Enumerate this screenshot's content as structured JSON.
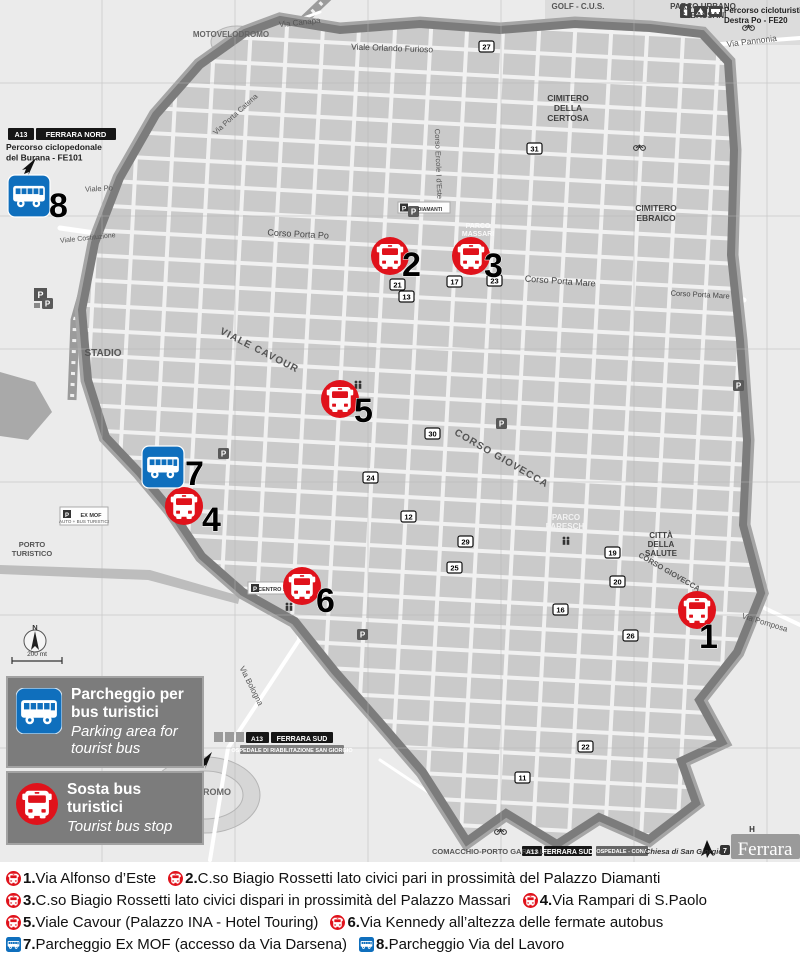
{
  "colors": {
    "stop_red": "#e0121b",
    "parking_blue": "#0f6fbd",
    "wall_gray": "#7c7c7c",
    "cemetery_gray": "#a6a6a6"
  },
  "map": {
    "markers": [
      {
        "num": "1",
        "type": "stop",
        "x": 697,
        "y": 610,
        "ndx": 2,
        "ndy": 38
      },
      {
        "num": "2",
        "type": "stop",
        "x": 390,
        "y": 256,
        "ndx": 12,
        "ndy": 20
      },
      {
        "num": "3",
        "type": "stop",
        "x": 471,
        "y": 256,
        "ndx": 13,
        "ndy": 21
      },
      {
        "num": "4",
        "type": "stop",
        "x": 184,
        "y": 506,
        "ndx": 18,
        "ndy": 25
      },
      {
        "num": "5",
        "type": "stop",
        "x": 340,
        "y": 399,
        "ndx": 14,
        "ndy": 23
      },
      {
        "num": "6",
        "type": "stop",
        "x": 302,
        "y": 586,
        "ndx": 14,
        "ndy": 26
      },
      {
        "num": "7",
        "type": "parking",
        "x": 163,
        "y": 467,
        "ndx": 22,
        "ndy": 18
      },
      {
        "num": "8",
        "type": "parking",
        "x": 29,
        "y": 196,
        "ndx": 20,
        "ndy": 21
      }
    ],
    "labels": [
      {
        "t": [
          "GOLF - C.U.S."
        ],
        "x": 578,
        "y": 9,
        "s": 8,
        "w": 700,
        "c": "#555"
      },
      {
        "t": [
          "PARCO URBANO",
          "G. BASSANI"
        ],
        "x": 703,
        "y": 9,
        "s": 8,
        "w": 700,
        "c": "#444",
        "lh": 9
      },
      {
        "t": [
          "Percorso cicloturistico",
          "Destra Po - FE20"
        ],
        "x": 724,
        "y": 13,
        "s": 8,
        "w": 700,
        "c": "#222",
        "a": "start",
        "lh": 10
      },
      {
        "t": [
          "Via Pannonia"
        ],
        "x": 752,
        "y": 44,
        "s": 8.5,
        "c": "#555",
        "r": -7
      },
      {
        "t": [
          "Via Canapa"
        ],
        "x": 300,
        "y": 25,
        "s": 8,
        "c": "#555",
        "r": -6
      },
      {
        "t": [
          "Viale Orlando Furioso"
        ],
        "x": 392,
        "y": 51,
        "s": 8.5,
        "c": "#444",
        "r": 2
      },
      {
        "t": [
          "MOTOVELODROMO"
        ],
        "x": 231,
        "y": 37,
        "s": 8,
        "w": 700,
        "c": "#666"
      },
      {
        "t": [
          "A13"
        ],
        "x": 21,
        "y": 137,
        "s": 7,
        "w": 700,
        "c": "#fff"
      },
      {
        "t": [
          "FERRARA NORD"
        ],
        "x": 76,
        "y": 137,
        "s": 7.5,
        "w": 700,
        "c": "#fff"
      },
      {
        "t": [
          "Percorso ciclopedonale",
          "del Burana - FE101"
        ],
        "x": 6,
        "y": 150,
        "s": 8.5,
        "w": 700,
        "c": "#222",
        "a": "start",
        "lh": 10.5
      },
      {
        "t": [
          "CIMITERO",
          "DELLA",
          "CERTOSA"
        ],
        "x": 568,
        "y": 101,
        "s": 8.5,
        "w": 700,
        "c": "#3f3f3f",
        "lh": 10
      },
      {
        "t": [
          "CIMITERO",
          "EBRAICO"
        ],
        "x": 656,
        "y": 211,
        "s": 8.5,
        "w": 700,
        "c": "#3f3f3f",
        "lh": 10
      },
      {
        "t": [
          "Viale Po"
        ],
        "x": 99,
        "y": 191,
        "s": 7.5,
        "c": "#555",
        "r": -3
      },
      {
        "t": [
          "Corso Porta Po"
        ],
        "x": 298,
        "y": 237,
        "s": 9,
        "c": "#444",
        "r": 3
      },
      {
        "t": [
          "Corso Porta Mare"
        ],
        "x": 560,
        "y": 284,
        "s": 9,
        "c": "#444",
        "r": 4
      },
      {
        "t": [
          "Corso Porta Mare"
        ],
        "x": 700,
        "y": 297,
        "s": 7.5,
        "c": "#444",
        "r": 3
      },
      {
        "t": [
          "Corso Ercole I d'Este"
        ],
        "x": 436,
        "y": 164,
        "s": 7.5,
        "c": "#555",
        "r": 88
      },
      {
        "t": [
          "VIALE CAVOUR"
        ],
        "x": 258,
        "y": 353,
        "s": 10,
        "w": 700,
        "c": "#555",
        "r": 27,
        "ls": 1
      },
      {
        "t": [
          "CORSO GIOVECCA"
        ],
        "x": 500,
        "y": 461,
        "s": 10,
        "w": 700,
        "c": "#555",
        "r": 30,
        "ls": 1
      },
      {
        "t": [
          "CORSO GIOVECCA"
        ],
        "x": 668,
        "y": 574,
        "s": 7.5,
        "w": 700,
        "c": "#555",
        "r": 30
      },
      {
        "t": [
          "STADIO"
        ],
        "x": 103,
        "y": 356,
        "s": 10,
        "w": 700,
        "c": "#555"
      },
      {
        "t": [
          "PARCO",
          "MASSARI"
        ],
        "x": 478,
        "y": 228,
        "s": 7,
        "w": 700,
        "c": "#fafafa",
        "lh": 8
      },
      {
        "t": [
          "PARCO",
          "PARESCHI"
        ],
        "x": 566,
        "y": 520,
        "s": 8,
        "w": 700,
        "c": "#f2f2f2",
        "lh": 9
      },
      {
        "t": [
          "CITTÀ",
          "DELLA",
          "SALUTE"
        ],
        "x": 661,
        "y": 538,
        "s": 8,
        "w": 700,
        "c": "#3f3f3f",
        "lh": 9
      },
      {
        "t": [
          "Via Pomposa"
        ],
        "x": 764,
        "y": 625,
        "s": 8,
        "c": "#555",
        "r": 17
      },
      {
        "t": [
          "Via Bologna"
        ],
        "x": 249,
        "y": 687,
        "s": 8,
        "c": "#555",
        "r": 63
      },
      {
        "t": [
          "IPPODROMO"
        ],
        "x": 203,
        "y": 795,
        "s": 9,
        "w": 700,
        "c": "#666"
      },
      {
        "t": [
          "PORTO",
          "TURISTICO"
        ],
        "x": 32,
        "y": 547,
        "s": 7.5,
        "w": 700,
        "c": "#555",
        "lh": 9
      },
      {
        "t": [
          "Viale Costituzione"
        ],
        "x": 88,
        "y": 240,
        "s": 7,
        "c": "#555",
        "r": -6
      },
      {
        "t": [
          "Via Porta Catena"
        ],
        "x": 237,
        "y": 116,
        "s": 7.5,
        "c": "#555",
        "r": -42
      },
      {
        "t": [
          "A13"
        ],
        "x": 257,
        "y": 741,
        "s": 6.5,
        "w": 700,
        "c": "#fff"
      },
      {
        "t": [
          "FERRARA SUD"
        ],
        "x": 302,
        "y": 741,
        "s": 7,
        "w": 700,
        "c": "#fff"
      },
      {
        "t": [
          "OSPEDALE DI RIABILITAZIONE SAN GIORGIO"
        ],
        "x": 292,
        "y": 752,
        "s": 5.5,
        "w": 700,
        "c": "#fff"
      },
      {
        "t": [
          "COMACCHIO-PORTO GARIBALDI /"
        ],
        "x": 432,
        "y": 854,
        "s": 7.5,
        "w": 700,
        "c": "#555",
        "a": "start"
      },
      {
        "t": [
          "A13"
        ],
        "x": 532,
        "y": 854,
        "s": 6.5,
        "w": 700,
        "c": "#fff"
      },
      {
        "t": [
          "FERRARA SUD"
        ],
        "x": 568,
        "y": 854,
        "s": 7,
        "w": 700,
        "c": "#fff"
      },
      {
        "t": [
          "OSPEDALE - CONA"
        ],
        "x": 622,
        "y": 853,
        "s": 5.5,
        "w": 700,
        "c": "#fff"
      },
      {
        "t": [
          "Chiesa di San Giorgio"
        ],
        "x": 645,
        "y": 854,
        "s": 7.5,
        "w": 700,
        "c": "#333",
        "a": "start",
        "i": 1
      },
      {
        "t": [
          "7"
        ],
        "x": 725,
        "y": 853,
        "s": 7,
        "w": 700,
        "c": "#fff"
      },
      {
        "t": [
          "Ferrara"
        ],
        "x": 765,
        "y": 855,
        "s": 19,
        "c": "#fff",
        "f": "serif"
      },
      {
        "t": [
          "H"
        ],
        "x": 752,
        "y": 832,
        "s": 8,
        "w": 700,
        "c": "#333"
      },
      {
        "t": [
          "N"
        ],
        "x": 35,
        "y": 630,
        "s": 7.5,
        "w": 700,
        "c": "#333"
      },
      {
        "t": [
          "200 mt"
        ],
        "x": 37,
        "y": 656,
        "s": 6.5,
        "c": "#333"
      },
      {
        "t": [
          "P"
        ],
        "x": 67,
        "y": 517,
        "s": 6,
        "w": 700,
        "c": "#fff"
      },
      {
        "t": [
          "EX MOF"
        ],
        "x": 91,
        "y": 517,
        "s": 5.5,
        "w": 700,
        "c": "#333"
      },
      {
        "t": [
          "AUTO + BUS TURISTICI"
        ],
        "x": 84,
        "y": 523,
        "s": 4.5,
        "c": "#555"
      },
      {
        "t": [
          "P"
        ],
        "x": 255,
        "y": 591,
        "s": 6,
        "w": 700,
        "c": "#fff"
      },
      {
        "t": [
          "CENTRO STORICO"
        ],
        "x": 283,
        "y": 591,
        "s": 5.5,
        "w": 700,
        "c": "#333"
      },
      {
        "t": [
          "DIAMANTI"
        ],
        "x": 430,
        "y": 211,
        "s": 5,
        "w": 700,
        "c": "#333"
      }
    ],
    "poi_badges": [
      {
        "n": "27",
        "x": 479,
        "y": 41
      },
      {
        "n": "21",
        "x": 390,
        "y": 279
      },
      {
        "n": "17",
        "x": 447,
        "y": 276
      },
      {
        "n": "13",
        "x": 399,
        "y": 291
      },
      {
        "n": "23",
        "x": 487,
        "y": 275
      },
      {
        "n": "31",
        "x": 527,
        "y": 143
      },
      {
        "n": "30",
        "x": 425,
        "y": 428
      },
      {
        "n": "24",
        "x": 363,
        "y": 472
      },
      {
        "n": "12",
        "x": 401,
        "y": 511
      },
      {
        "n": "29",
        "x": 458,
        "y": 536
      },
      {
        "n": "25",
        "x": 447,
        "y": 562
      },
      {
        "n": "11",
        "x": 515,
        "y": 772
      },
      {
        "n": "22",
        "x": 578,
        "y": 741
      },
      {
        "n": "26",
        "x": 623,
        "y": 630
      },
      {
        "n": "16",
        "x": 553,
        "y": 604
      },
      {
        "n": "20",
        "x": 610,
        "y": 576
      },
      {
        "n": "19",
        "x": 605,
        "y": 547
      }
    ],
    "p_badges": [
      [
        42,
        298
      ],
      [
        408,
        206
      ],
      [
        357,
        629
      ],
      [
        496,
        418
      ],
      [
        218,
        448
      ],
      [
        733,
        380
      ]
    ]
  },
  "legend": {
    "items": [
      {
        "icon": "parking",
        "title_lines": [
          "Parcheggio per",
          "bus turistici"
        ],
        "subtitle_lines": [
          "Parking area for",
          "tourist bus"
        ]
      },
      {
        "icon": "stop",
        "title_lines": [
          "Sosta bus",
          "turistici"
        ],
        "subtitle_lines": [
          "Tourist bus stop"
        ]
      }
    ]
  },
  "caption": {
    "lines": [
      {
        "segments": [
          {
            "icon": "stop",
            "num": "1.",
            "text": " Via Alfonso d’Este"
          },
          {
            "icon": "stop",
            "num": "2.",
            "text": " C.so Biagio Rossetti lato civici pari in prossimità del Palazzo Diamanti"
          }
        ]
      },
      {
        "segments": [
          {
            "icon": "stop",
            "num": "3.",
            "text": " C.so Biagio Rossetti lato civici dispari in prossimità del Palazzo Massari"
          },
          {
            "icon": "stop",
            "num": "4.",
            "text": "Via Rampari di S.Paolo"
          }
        ]
      },
      {
        "segments": [
          {
            "icon": "stop",
            "num": "5.",
            "text": "Viale Cavour (Palazzo INA - Hotel Touring)"
          },
          {
            "icon": "stop",
            "num": "6.",
            "text": "Via Kennedy all’altezza delle fermate autobus"
          }
        ]
      },
      {
        "segments": [
          {
            "icon": "parking",
            "num": "7.",
            "text": " Parcheggio Ex MOF (accesso da Via Darsena)"
          },
          {
            "icon": "parking",
            "num": "8.",
            "text": " Parcheggio Via del Lavoro"
          }
        ]
      }
    ]
  }
}
